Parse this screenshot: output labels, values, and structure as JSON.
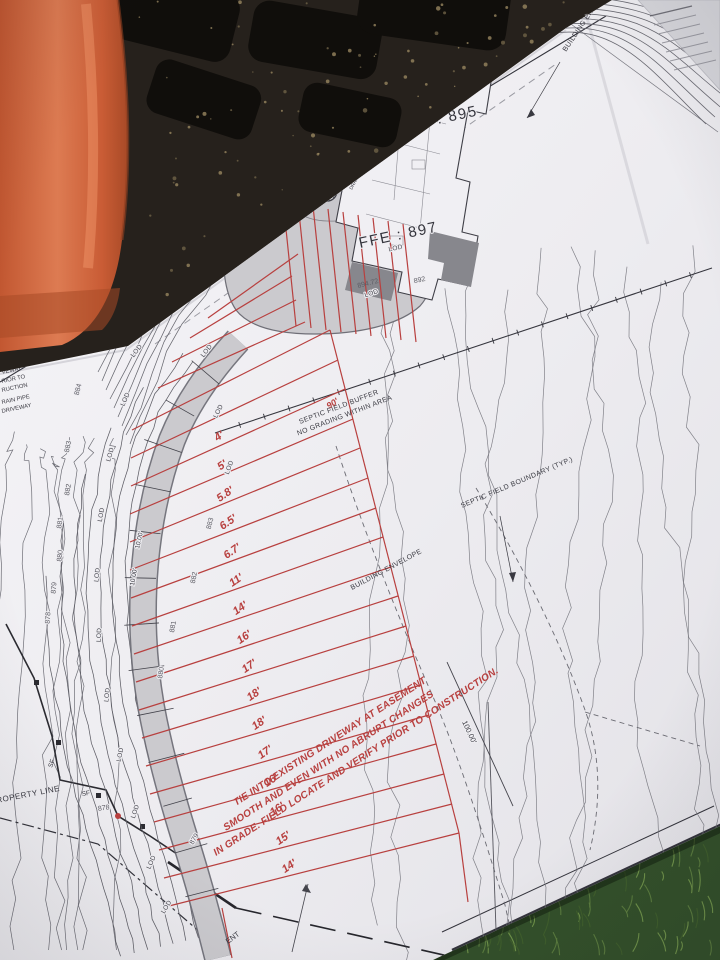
{
  "photo": {
    "colors": {
      "paper": "#f0eff3",
      "linework": "#3f3f47",
      "red_accent": "#b8403f",
      "driveway_gray": "#cbcace",
      "orange_equipment": "#d0653f",
      "grass_green": "#33502a",
      "tire_black": "#26211c"
    }
  },
  "plan": {
    "ffe_upper": "FFE : 895",
    "ffe_lower": "FFE : 897",
    "drain_outfall_1": "DRAIN OUTFALL",
    "drain_outfall_2": "TO SWALE",
    "septic_buffer_1": "SEPTIC FIELD BUFFER",
    "septic_buffer_2": "NO GRADING WITHIN AREA",
    "septic_boundary": "SEPTIC FIELD BOUNDARY (TYP.)",
    "building_envelope": "BUILDING ENVELOPE",
    "building_envelope_top": "BUILDING ENVELOPE",
    "property_line": "ROPERTY LINE",
    "red_note_1": "TIE INTO EXISTING DRIVEWAY AT EASEMENT",
    "red_note_2": "SMOOTH AND EVEN WITH NO ABRUPT CHANGES",
    "red_note_3": "IN GRADE.  FIELD LOCATE AND VERIFY PRIOR TO CONSTRUCTION.",
    "dim_100": "100.00'",
    "driveway_width": "10.00'",
    "lod": "LOD",
    "sf": "SF",
    "red_90": "90'",
    "drain_inlet": "DRAIN INLET 894.50",
    "partial_bottom": "ENT",
    "edge_partials": [
      "VEWAY",
      "RIOR TO",
      "RUCTION",
      "RAIN PIPE",
      "DRIVEWAY"
    ],
    "contour_labels": [
      "888",
      "887",
      "886",
      "885",
      "884",
      "883",
      "882",
      "881",
      "880",
      "879",
      "878",
      "883",
      "882",
      "881",
      "880",
      "879",
      "878",
      "890",
      "886",
      "885",
      "884",
      "902",
      "903",
      "892"
    ],
    "spot_elevations": [
      "896.20",
      "894.48",
      "894.49",
      "894.72"
    ],
    "red_dims": [
      "4'",
      "5'",
      "5.8'",
      "6.5'",
      "6.7'",
      "11'",
      "14'",
      "16'",
      "17'",
      "18'",
      "18'",
      "17'",
      "16'",
      "16'",
      "15'",
      "14'"
    ]
  }
}
